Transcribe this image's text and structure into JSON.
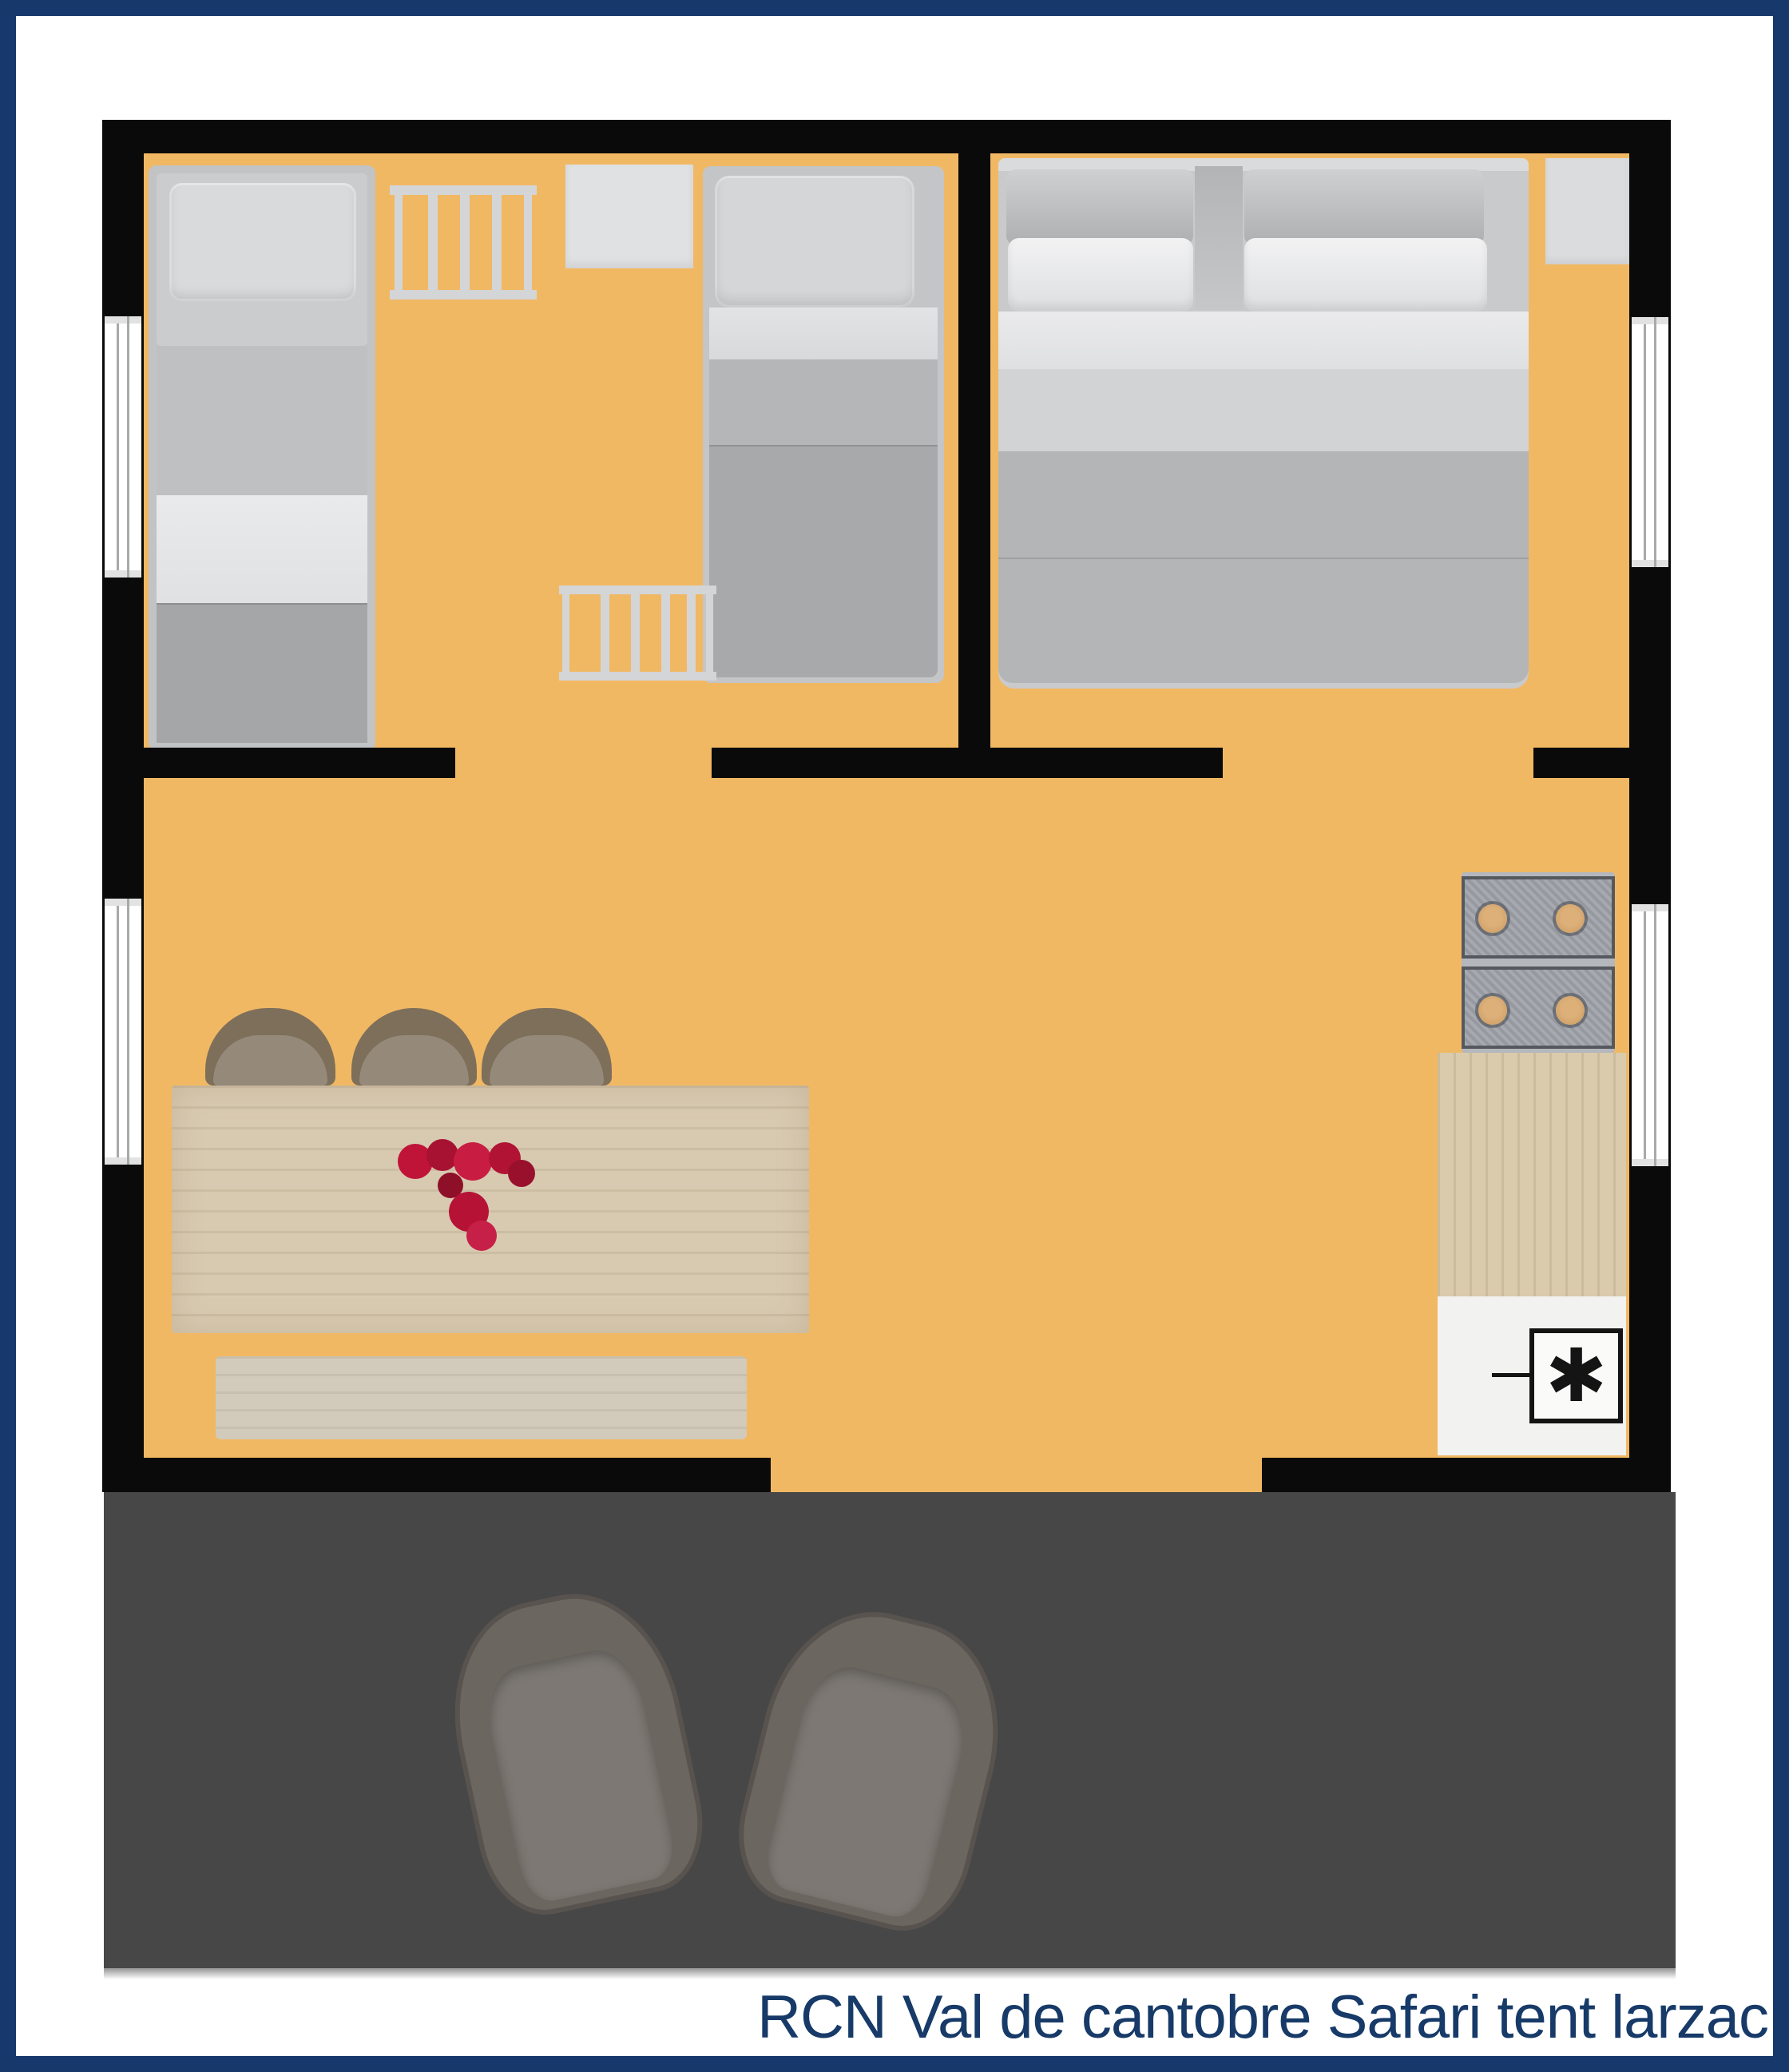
{
  "caption": "RCN Val de cantobre Safari tent larzac",
  "fridge": {
    "symbol": "✱"
  },
  "colors": {
    "border_navy": "#16386B",
    "caption_text": "#173A68",
    "wall_black": "#0A0A0A",
    "floor_orange": "#F1B863",
    "deck_gray": "#474747",
    "flower_red": "#B81336"
  },
  "icons": {
    "fridge_symbol_icon": "asterisk-freezer-icon"
  }
}
